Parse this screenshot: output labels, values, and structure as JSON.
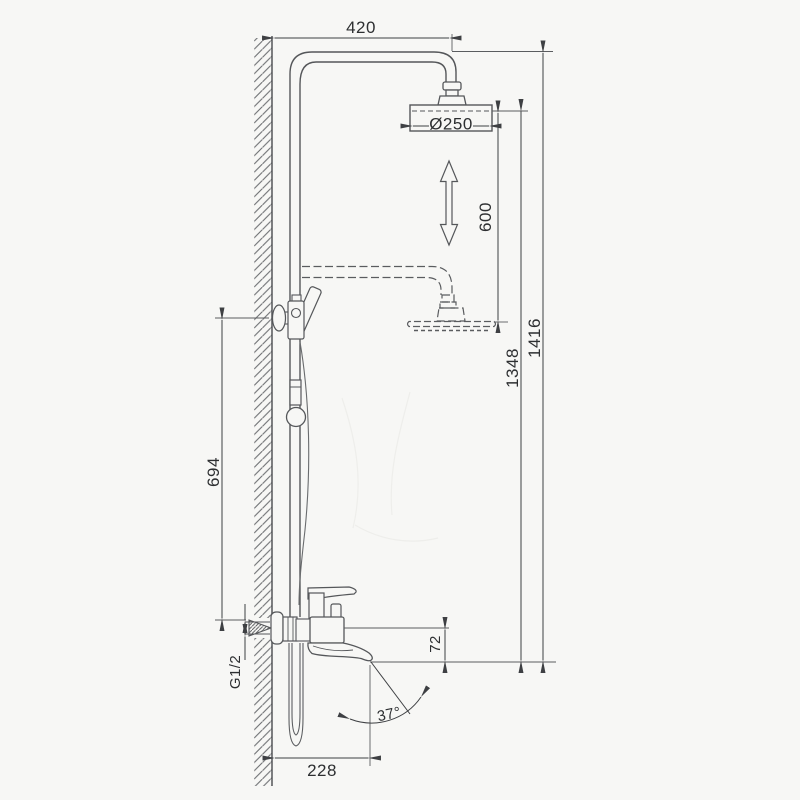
{
  "drawing": {
    "kind": "technical-line-drawing",
    "colors": {
      "fixture_line": "#55575a",
      "dimension_line": "#3e4043",
      "text": "#2d2f31",
      "background": "#f7f7f5"
    }
  },
  "dimensions": {
    "arm_reach": "420",
    "head_diameter": "Ø250",
    "height_adjustment": "600",
    "total_height": "1416",
    "head_height": "1348",
    "hand_shower_height": "694",
    "connection_thread": "G1/2",
    "spout_drop": "72",
    "spout_reach": "228",
    "spout_angle": "37°"
  }
}
